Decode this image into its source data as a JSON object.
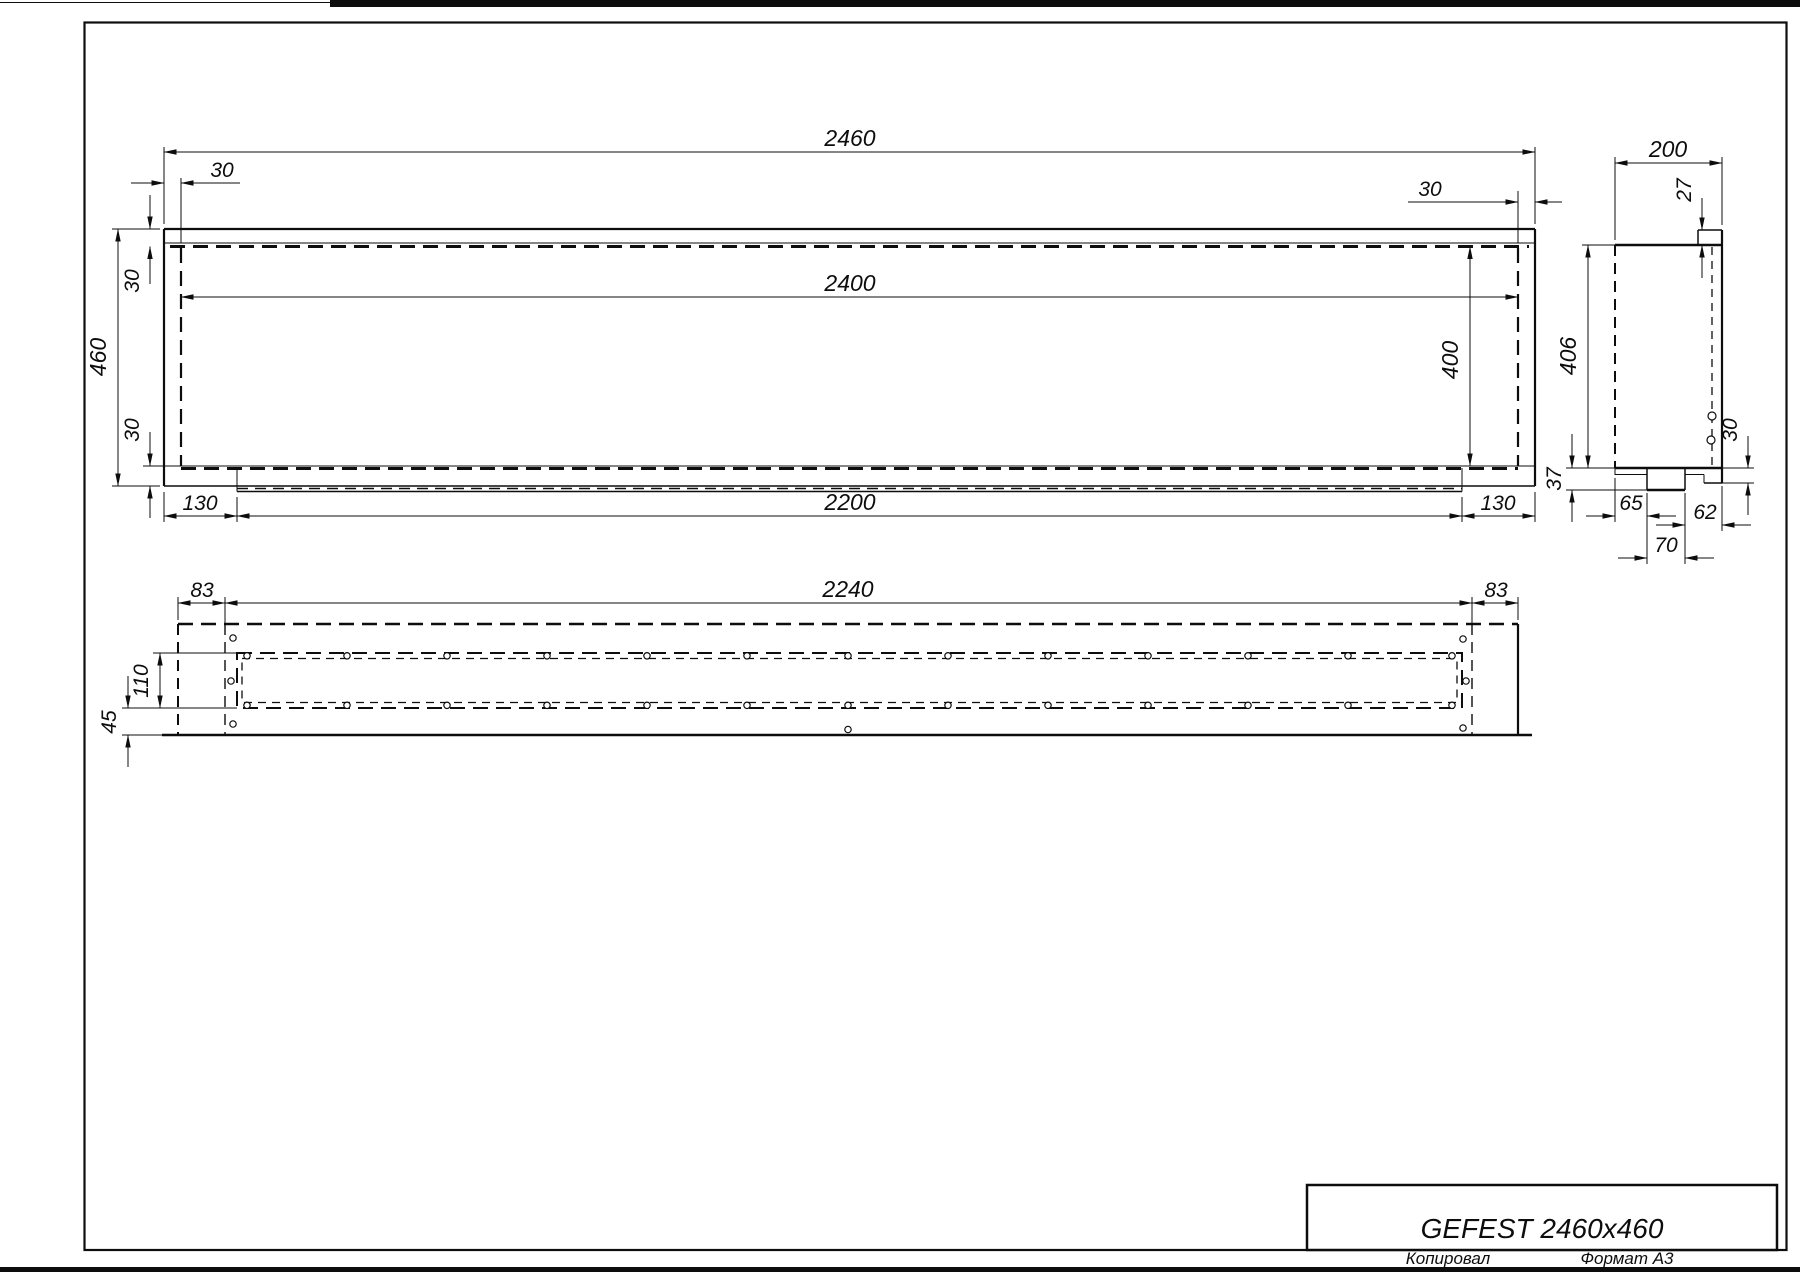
{
  "sheet": {
    "copied_label": "Копировал",
    "format_label": "Формат А3"
  },
  "title_block": {
    "model": "GEFEST 2460x460"
  },
  "front_view": {
    "dims": {
      "overall_width": "2460",
      "left_wall": "30",
      "right_wall": "30",
      "opening_width": "2400",
      "overall_height": "460",
      "top_wall": "30",
      "bottom_wall": "30",
      "opening_height": "400",
      "tray_left": "130",
      "tray_length": "2200",
      "tray_right": "130"
    }
  },
  "side_view": {
    "dims": {
      "depth": "200",
      "glass_lip": "27",
      "inner_height": "406",
      "base_height": "37",
      "foot_front": "65",
      "notch_width": "70",
      "foot_back": "62",
      "lip_height": "30"
    }
  },
  "bottom_view": {
    "dims": {
      "left_margin": "83",
      "slot_length": "2240",
      "right_margin": "83",
      "slot_width": "110",
      "front_margin": "45"
    }
  }
}
